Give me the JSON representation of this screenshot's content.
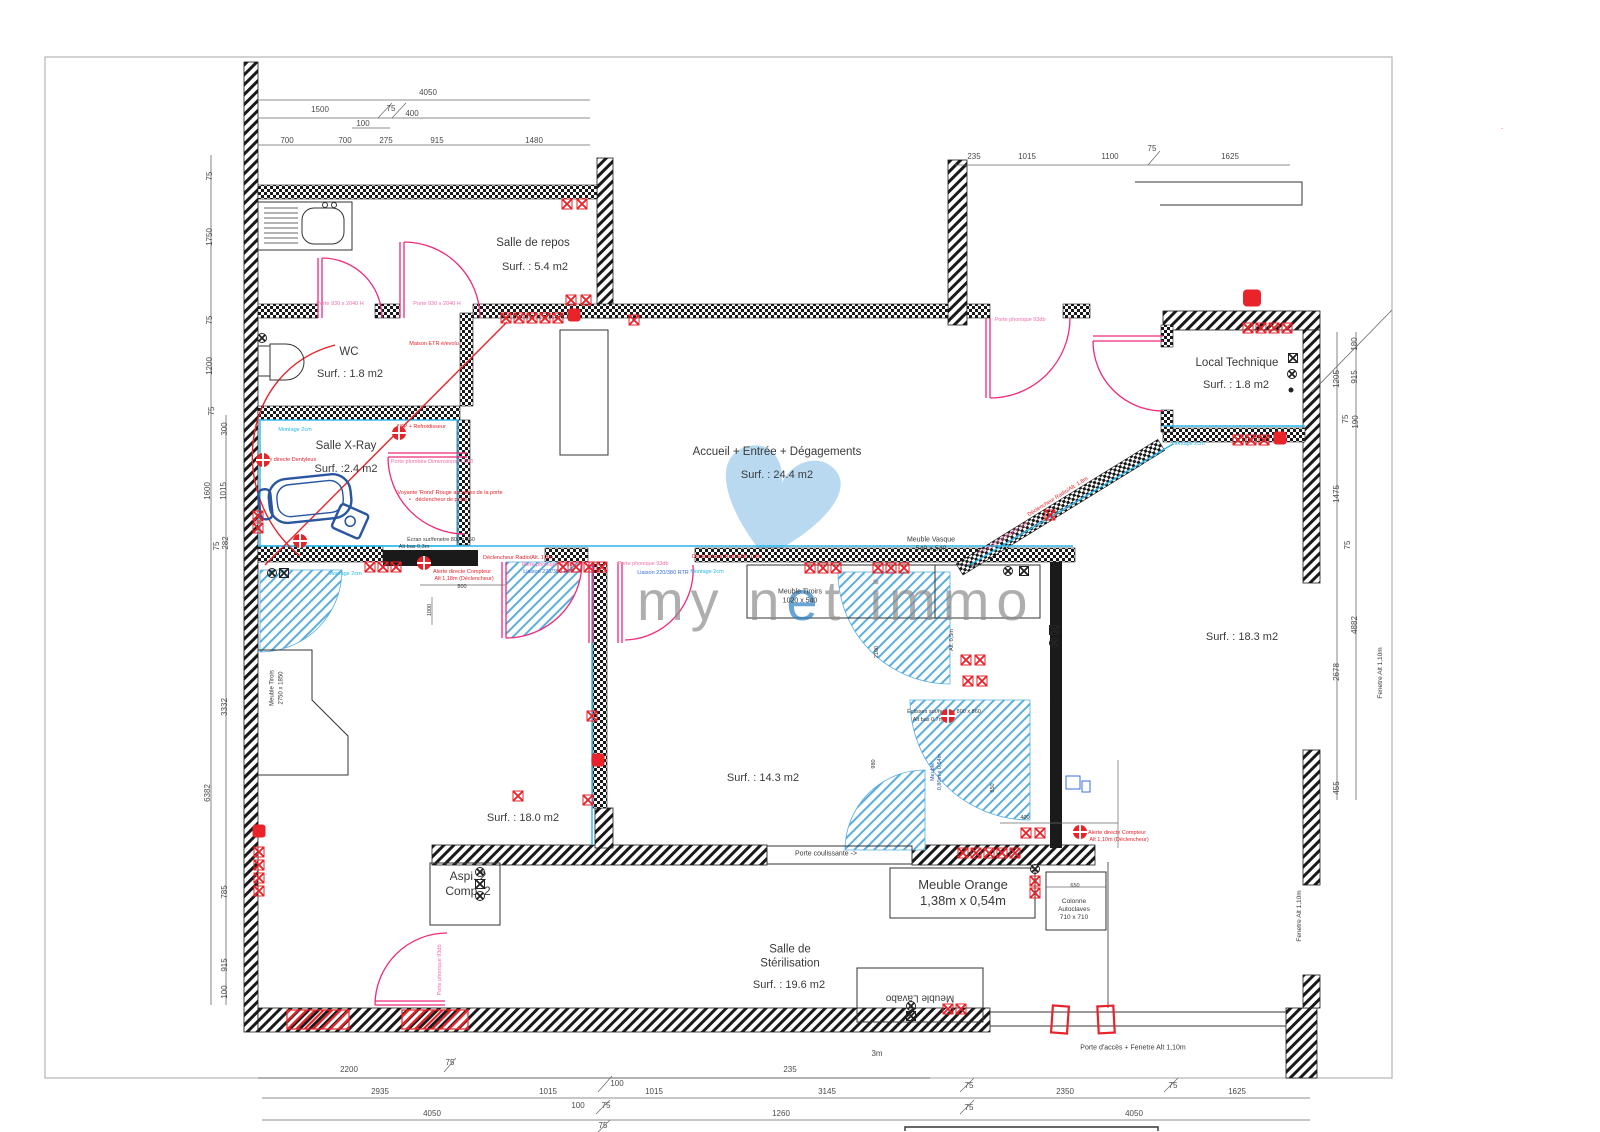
{
  "palette": {
    "wall": "#1a1a1a",
    "red": "#e8232a",
    "pink": "#ee2a7b",
    "pink_label": "#f06eaa",
    "cyan": "#29b7ea",
    "blue": "#3a6fd8",
    "chair_blue": "#2a55a0",
    "hatch_blue": "#5aaede",
    "watermark_gray": "#8d8d8d",
    "watermark_blue": "#2a7fc1",
    "heart_blue": "#aed4ee",
    "dim_text": "#4a4a4a"
  },
  "watermark": {
    "part1": "my n",
    "accent": "e",
    "part2": "t immo"
  },
  "rooms": [
    {
      "name": "Salle de repos",
      "surf": "Surf. : 5.4 m2",
      "x": 533,
      "y": 243,
      "sx": 535,
      "sy": 268
    },
    {
      "name": "WC",
      "surf": "Surf. : 1.8 m2",
      "x": 349,
      "y": 352,
      "sx": 350,
      "sy": 375
    },
    {
      "name": "Salle X-Ray",
      "surf": "Surf. :2.4 m2",
      "x": 346,
      "y": 446,
      "sx": 346,
      "sy": 470
    },
    {
      "name": "Accueil + Entrée + Dégagements",
      "surf": "Surf. : 24.4 m2",
      "x": 777,
      "y": 452,
      "sx": 777,
      "sy": 476
    },
    {
      "name": "Local Technique",
      "surf": "Surf. : 1.8 m2",
      "x": 1237,
      "y": 363,
      "sx": 1236,
      "sy": 386
    },
    {
      "name": "",
      "surf": "Surf. : 18.3 m2",
      "x": 0,
      "y": 0,
      "sx": 1242,
      "sy": 638
    },
    {
      "name": "",
      "surf": "Surf. : 18.0 m2",
      "x": 0,
      "y": 0,
      "sx": 523,
      "sy": 819
    },
    {
      "name": "",
      "surf": "Surf. : 14.3 m2",
      "x": 0,
      "y": 0,
      "sx": 763,
      "sy": 779
    },
    {
      "name": "Salle de\nStérilisation",
      "surf": "Surf. : 19.6 m2",
      "x": 790,
      "y": 957,
      "sx": 789,
      "sy": 986
    }
  ],
  "furniture_labels": [
    {
      "t": "Meuble Vasque\n540 x 540",
      "x": 931,
      "y": 545,
      "fs": 7
    },
    {
      "t": "Meuble Tiroirs\n1020 x 540",
      "x": 800,
      "y": 597,
      "fs": 7
    },
    {
      "t": "Meuble Orange\n1,38m x 0,54m",
      "x": 963,
      "y": 893,
      "fs": 13
    },
    {
      "t": "Colonne\nAutoclaves\n710 x 710",
      "x": 1074,
      "y": 910,
      "fs": 6.5
    },
    {
      "t": "Meuble Lavabo",
      "x": 920,
      "y": 997,
      "fs": 10,
      "rot": 180
    },
    {
      "t": "Aspi. 2\nComp. 2",
      "x": 468,
      "y": 884,
      "fs": 12
    },
    {
      "t": "Porte coulissante ->",
      "x": 826,
      "y": 855,
      "fs": 7
    },
    {
      "t": "Porte d'accès + Fenetre Alt 1,10m",
      "x": 1133,
      "y": 1049,
      "fs": 7
    },
    {
      "t": "Fenetre Alt 1,10m",
      "x": 1381,
      "y": 673,
      "fs": 6.5,
      "rot": -90
    },
    {
      "t": "Fenetre Alt 1,10m",
      "x": 1300,
      "y": 916,
      "fs": 6.5,
      "rot": -90
    },
    {
      "t": "Meuble Tirois",
      "x": 273,
      "y": 688,
      "fs": 6,
      "rot": -90
    },
    {
      "t": "2750 x 1850",
      "x": 282,
      "y": 688,
      "fs": 6,
      "rot": -90
    },
    {
      "t": "Meuble\n0,80m x 0,54m",
      "x": 937,
      "y": 772,
      "fs": 5.5,
      "rot": -90,
      "c": "#2a55a0"
    }
  ],
  "dimensions": [
    {
      "t": "4050",
      "x": 428,
      "y": 93
    },
    {
      "t": "1500",
      "x": 320,
      "y": 110
    },
    {
      "t": "75",
      "x": 391,
      "y": 109
    },
    {
      "t": "400",
      "x": 412,
      "y": 114
    },
    {
      "t": "100",
      "x": 363,
      "y": 124
    },
    {
      "t": "700",
      "x": 287,
      "y": 141
    },
    {
      "t": "700",
      "x": 345,
      "y": 141
    },
    {
      "t": "275",
      "x": 386,
      "y": 141
    },
    {
      "t": "915",
      "x": 437,
      "y": 141
    },
    {
      "t": "1480",
      "x": 534,
      "y": 141
    },
    {
      "t": "235",
      "x": 974,
      "y": 157
    },
    {
      "t": "1015",
      "x": 1027,
      "y": 157
    },
    {
      "t": "1100",
      "x": 1110,
      "y": 157
    },
    {
      "t": "75",
      "x": 1152,
      "y": 149
    },
    {
      "t": "1625",
      "x": 1230,
      "y": 157
    },
    {
      "t": "75",
      "x": 210,
      "y": 176,
      "rot": -90
    },
    {
      "t": "1750",
      "x": 210,
      "y": 237,
      "rot": -90
    },
    {
      "t": "75",
      "x": 210,
      "y": 320,
      "rot": -90
    },
    {
      "t": "1200",
      "x": 210,
      "y": 366,
      "rot": -90
    },
    {
      "t": "75",
      "x": 212,
      "y": 411,
      "rot": -90
    },
    {
      "t": "300",
      "x": 225,
      "y": 429,
      "rot": -90
    },
    {
      "t": "1600",
      "x": 208,
      "y": 491,
      "rot": -90
    },
    {
      "t": "1015",
      "x": 224,
      "y": 491,
      "rot": -90
    },
    {
      "t": "75",
      "x": 217,
      "y": 546,
      "rot": -90
    },
    {
      "t": "282",
      "x": 226,
      "y": 543,
      "rot": -90
    },
    {
      "t": "3332",
      "x": 225,
      "y": 707,
      "rot": -90
    },
    {
      "t": "6382",
      "x": 208,
      "y": 793,
      "rot": -90
    },
    {
      "t": "785",
      "x": 225,
      "y": 892,
      "rot": -90
    },
    {
      "t": "915",
      "x": 225,
      "y": 965,
      "rot": -90
    },
    {
      "t": "100",
      "x": 225,
      "y": 992,
      "rot": -90
    },
    {
      "t": "1205",
      "x": 1337,
      "y": 379,
      "rot": -90
    },
    {
      "t": "915",
      "x": 1355,
      "y": 377,
      "rot": -90
    },
    {
      "t": "180",
      "x": 1355,
      "y": 344,
      "rot": -90
    },
    {
      "t": "75",
      "x": 1346,
      "y": 419,
      "rot": -90
    },
    {
      "t": "190",
      "x": 1356,
      "y": 422,
      "rot": -90
    },
    {
      "t": "1475",
      "x": 1337,
      "y": 494,
      "rot": -90
    },
    {
      "t": "75",
      "x": 1348,
      "y": 545,
      "rot": -90
    },
    {
      "t": "4882",
      "x": 1355,
      "y": 625,
      "rot": -90
    },
    {
      "t": "2678",
      "x": 1337,
      "y": 672,
      "rot": -90
    },
    {
      "t": "455",
      "x": 1337,
      "y": 788,
      "rot": -90
    },
    {
      "t": "2200",
      "x": 349,
      "y": 1070
    },
    {
      "t": "75",
      "x": 450,
      "y": 1063
    },
    {
      "t": "235",
      "x": 790,
      "y": 1070
    },
    {
      "t": "3m",
      "x": 877,
      "y": 1054
    },
    {
      "t": "2935",
      "x": 380,
      "y": 1092
    },
    {
      "t": "1015",
      "x": 548,
      "y": 1092
    },
    {
      "t": "100",
      "x": 617,
      "y": 1084
    },
    {
      "t": "100",
      "x": 578,
      "y": 1106
    },
    {
      "t": "75",
      "x": 606,
      "y": 1106
    },
    {
      "t": "1015",
      "x": 654,
      "y": 1092
    },
    {
      "t": "3145",
      "x": 827,
      "y": 1092
    },
    {
      "t": "75",
      "x": 969,
      "y": 1086
    },
    {
      "t": "2350",
      "x": 1065,
      "y": 1092
    },
    {
      "t": "75",
      "x": 1173,
      "y": 1086
    },
    {
      "t": "1625",
      "x": 1237,
      "y": 1092
    },
    {
      "t": "4050",
      "x": 432,
      "y": 1114
    },
    {
      "t": "75",
      "x": 603,
      "y": 1126
    },
    {
      "t": "1260",
      "x": 781,
      "y": 1114
    },
    {
      "t": "75",
      "x": 969,
      "y": 1108
    },
    {
      "t": "4050",
      "x": 1134,
      "y": 1114
    }
  ],
  "micro_labels": [
    {
      "t": "Maison ETR é/evolu",
      "x": 434,
      "y": 344,
      "c": "red"
    },
    {
      "t": "ASP + Refroidisseur",
      "x": 421,
      "y": 427,
      "c": "red"
    },
    {
      "t": "Porte plombée Dimensions H.863",
      "x": 432,
      "y": 462,
      "c": "pink"
    },
    {
      "t": "Voyante 'Rond' Rouge accolées de la porte",
      "x": 450,
      "y": 493,
      "c": "red"
    },
    {
      "t": "•   déclencheur de porte",
      "x": 438,
      "y": 500,
      "c": "red"
    },
    {
      "t": "Montage 2cm",
      "x": 295,
      "y": 430,
      "c": "cyan"
    },
    {
      "t": "Alerte directe Dentyleux",
      "x": 287,
      "y": 460,
      "c": "red"
    },
    {
      "t": "Écran sur/fenetre 800 x 860",
      "x": 441,
      "y": 540,
      "c": "black"
    },
    {
      "t": "Alt bas 0,3m",
      "x": 414,
      "y": 547,
      "c": "black"
    },
    {
      "t": "Déclencheur Radio/Alt. 1,8m",
      "x": 518,
      "y": 558,
      "c": "red"
    },
    {
      "t": "Porte phonique 93db",
      "x": 547,
      "y": 565,
      "c": "pink"
    },
    {
      "t": "Liaison 220/380 RTR",
      "x": 549,
      "y": 572,
      "c": "blue"
    },
    {
      "t": "Montage 2cm",
      "x": 345,
      "y": 574,
      "c": "cyan"
    },
    {
      "t": "Alerte directe Compteur",
      "x": 462,
      "y": 572,
      "c": "red"
    },
    {
      "t": "Alt 1,18m (Déclencheur)",
      "x": 464,
      "y": 579,
      "c": "red"
    },
    {
      "t": "800",
      "x": 462,
      "y": 587,
      "c": "black"
    },
    {
      "t": "Déclencheur Radio/Alt. 1,8m",
      "x": 727,
      "y": 557,
      "c": "red"
    },
    {
      "t": "Porte phonique 93db",
      "x": 643,
      "y": 564,
      "c": "pink"
    },
    {
      "t": "Liaison 220/380 RTR",
      "x": 663,
      "y": 573,
      "c": "blue"
    },
    {
      "t": "Montage 2cm",
      "x": 707,
      "y": 572,
      "c": "cyan"
    },
    {
      "t": "Porte phonique 93db",
      "x": 1020,
      "y": 320,
      "c": "pink"
    },
    {
      "t": "Déclencheur Radio/Alt. 1,8m",
      "x": 1058,
      "y": 497,
      "c": "red",
      "rot": -32
    },
    {
      "t": "Porte gris/grillagée 2cm",
      "x": 1004,
      "y": 538,
      "c": "pink",
      "rot": -32
    },
    {
      "t": "Montage 2cm",
      "x": 1188,
      "y": 444,
      "c": "cyan"
    },
    {
      "t": "Éclisses sur/fenetre 800 x 860",
      "x": 944,
      "y": 712,
      "c": "black"
    },
    {
      "t": "Alt bas 0,7m",
      "x": 928,
      "y": 720,
      "c": "black"
    },
    {
      "t": "Alerte directe Compteur",
      "x": 1117,
      "y": 833,
      "c": "red"
    },
    {
      "t": "Alt 1,10m (Déclencheur)",
      "x": 1119,
      "y": 840,
      "c": "red"
    },
    {
      "t": "Porte phonique 93db",
      "x": 440,
      "y": 970,
      "c": "pink",
      "rot": -90
    },
    {
      "t": "Porte 930 x 2040 H",
      "x": 340,
      "y": 304,
      "c": "pink"
    },
    {
      "t": "Porte 930 x 2040 H",
      "x": 437,
      "y": 304,
      "c": "pink"
    },
    {
      "t": "Alt. 0,5m",
      "x": 952,
      "y": 640,
      "c": "black",
      "rot": -90
    },
    {
      "t": "2100",
      "x": 877,
      "y": 652,
      "c": "black",
      "rot": -90
    },
    {
      "t": "980",
      "x": 874,
      "y": 764,
      "c": "black",
      "rot": -90
    },
    {
      "t": "850",
      "x": 993,
      "y": 788,
      "c": "black",
      "rot": -90
    },
    {
      "t": "1000",
      "x": 430,
      "y": 610,
      "c": "black",
      "rot": -90
    },
    {
      "t": "400",
      "x": 1025,
      "y": 818,
      "c": "black"
    },
    {
      "t": "650",
      "x": 1075,
      "y": 886,
      "c": "black"
    },
    {
      "t": "-",
      "x": 1502,
      "y": 129,
      "c": "red"
    }
  ],
  "outlets": [
    {
      "x": 567,
      "y": 204,
      "t": "sq"
    },
    {
      "x": 582,
      "y": 204,
      "t": "sq"
    },
    {
      "x": 571,
      "y": 300,
      "t": "sq"
    },
    {
      "x": 586,
      "y": 300,
      "t": "sq"
    },
    {
      "x": 506,
      "y": 318,
      "t": "sq"
    },
    {
      "x": 519,
      "y": 318,
      "t": "sq"
    },
    {
      "x": 532,
      "y": 318,
      "t": "sq"
    },
    {
      "x": 545,
      "y": 318,
      "t": "sq"
    },
    {
      "x": 558,
      "y": 318,
      "t": "sq"
    },
    {
      "x": 574,
      "y": 315,
      "t": "blob"
    },
    {
      "x": 634,
      "y": 320,
      "t": "sq"
    },
    {
      "x": 262,
      "y": 338,
      "t": "blk"
    },
    {
      "x": 1252,
      "y": 298,
      "t": "blob2"
    },
    {
      "x": 1248,
      "y": 328,
      "t": "sq"
    },
    {
      "x": 1261,
      "y": 328,
      "t": "sq"
    },
    {
      "x": 1274,
      "y": 328,
      "t": "sq"
    },
    {
      "x": 1287,
      "y": 328,
      "t": "sq"
    },
    {
      "x": 1293,
      "y": 358,
      "t": "blksq"
    },
    {
      "x": 1292,
      "y": 374,
      "t": "blk"
    },
    {
      "x": 1291,
      "y": 390,
      "t": "blkdot"
    },
    {
      "x": 1238,
      "y": 440,
      "t": "sq"
    },
    {
      "x": 1251,
      "y": 440,
      "t": "sq"
    },
    {
      "x": 1264,
      "y": 440,
      "t": "sq"
    },
    {
      "x": 1280,
      "y": 438,
      "t": "blob"
    },
    {
      "x": 258,
      "y": 516,
      "t": "sq"
    },
    {
      "x": 258,
      "y": 528,
      "t": "sq"
    },
    {
      "x": 263,
      "y": 460,
      "t": "circ"
    },
    {
      "x": 300,
      "y": 541,
      "t": "circ"
    },
    {
      "x": 399,
      "y": 433,
      "t": "circ"
    },
    {
      "x": 370,
      "y": 567,
      "t": "sq"
    },
    {
      "x": 383,
      "y": 567,
      "t": "sq"
    },
    {
      "x": 396,
      "y": 567,
      "t": "sq"
    },
    {
      "x": 424,
      "y": 563,
      "t": "circ"
    },
    {
      "x": 563,
      "y": 567,
      "t": "sq"
    },
    {
      "x": 576,
      "y": 567,
      "t": "sq"
    },
    {
      "x": 589,
      "y": 567,
      "t": "sq"
    },
    {
      "x": 602,
      "y": 567,
      "t": "sq"
    },
    {
      "x": 810,
      "y": 568,
      "t": "sq"
    },
    {
      "x": 823,
      "y": 568,
      "t": "sq"
    },
    {
      "x": 836,
      "y": 568,
      "t": "sq"
    },
    {
      "x": 878,
      "y": 568,
      "t": "sq"
    },
    {
      "x": 891,
      "y": 568,
      "t": "sq"
    },
    {
      "x": 904,
      "y": 568,
      "t": "sq"
    },
    {
      "x": 1050,
      "y": 515,
      "t": "sq"
    },
    {
      "x": 272,
      "y": 573,
      "t": "blk"
    },
    {
      "x": 284,
      "y": 573,
      "t": "blksq"
    },
    {
      "x": 1008,
      "y": 571,
      "t": "blk"
    },
    {
      "x": 1024,
      "y": 571,
      "t": "blksq"
    },
    {
      "x": 966,
      "y": 660,
      "t": "sq"
    },
    {
      "x": 980,
      "y": 660,
      "t": "sq"
    },
    {
      "x": 968,
      "y": 681,
      "t": "sq"
    },
    {
      "x": 982,
      "y": 681,
      "t": "sq"
    },
    {
      "x": 1054,
      "y": 630,
      "t": "blksq"
    },
    {
      "x": 1054,
      "y": 643,
      "t": "blk"
    },
    {
      "x": 948,
      "y": 716,
      "t": "circ"
    },
    {
      "x": 592,
      "y": 716,
      "t": "sq"
    },
    {
      "x": 598,
      "y": 760,
      "t": "blob"
    },
    {
      "x": 518,
      "y": 796,
      "t": "sq"
    },
    {
      "x": 588,
      "y": 800,
      "t": "sq"
    },
    {
      "x": 259,
      "y": 831,
      "t": "blob"
    },
    {
      "x": 259,
      "y": 852,
      "t": "sq"
    },
    {
      "x": 259,
      "y": 865,
      "t": "sq"
    },
    {
      "x": 259,
      "y": 878,
      "t": "sq"
    },
    {
      "x": 259,
      "y": 891,
      "t": "sq"
    },
    {
      "x": 1026,
      "y": 833,
      "t": "sq"
    },
    {
      "x": 1040,
      "y": 833,
      "t": "sq"
    },
    {
      "x": 1080,
      "y": 832,
      "t": "circ"
    },
    {
      "x": 963,
      "y": 853,
      "t": "sq"
    },
    {
      "x": 976,
      "y": 853,
      "t": "sq"
    },
    {
      "x": 989,
      "y": 853,
      "t": "sq"
    },
    {
      "x": 1002,
      "y": 853,
      "t": "sq"
    },
    {
      "x": 1015,
      "y": 853,
      "t": "sq"
    },
    {
      "x": 1035,
      "y": 869,
      "t": "blk"
    },
    {
      "x": 1035,
      "y": 881,
      "t": "sq"
    },
    {
      "x": 1035,
      "y": 893,
      "t": "sq"
    },
    {
      "x": 480,
      "y": 872,
      "t": "blk"
    },
    {
      "x": 480,
      "y": 884,
      "t": "blksq"
    },
    {
      "x": 480,
      "y": 896,
      "t": "blk"
    },
    {
      "x": 911,
      "y": 1006,
      "t": "blk"
    },
    {
      "x": 911,
      "y": 1016,
      "t": "blksq"
    },
    {
      "x": 948,
      "y": 1009,
      "t": "sq"
    },
    {
      "x": 961,
      "y": 1009,
      "t": "sq"
    }
  ]
}
